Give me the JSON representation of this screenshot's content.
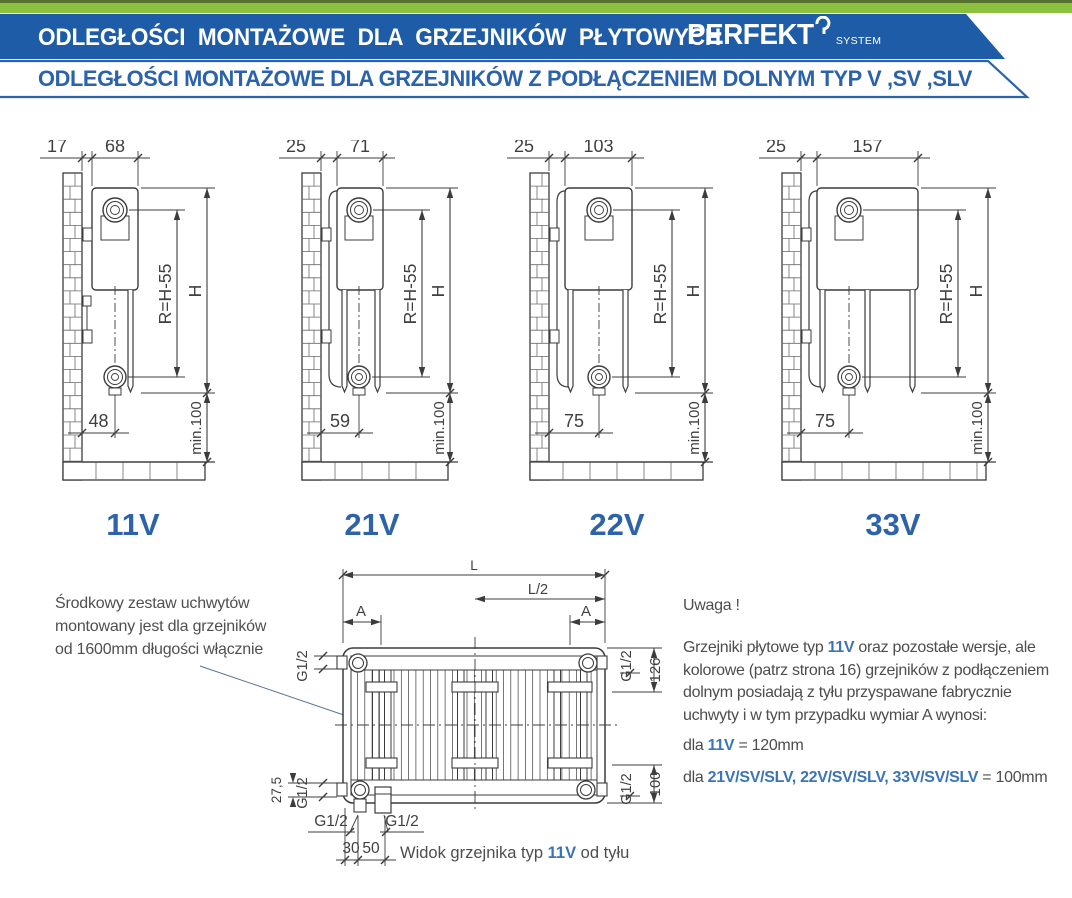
{
  "header": {
    "title_main": "ODLEGŁOŚCI  MONTAŻOWE  DLA GRZEJNIKÓW  PŁYTOWYCH",
    "logo_text": "PERFEKT",
    "logo_sub": "SYSTEM",
    "subtitle": "ODLEGŁOŚCI MONTAŻOWE DLA GRZEJNIKÓW Z PODŁĄCZENIEM DOLNYM TYP V ,SV ,SLV",
    "colors": {
      "green": "#8CC13F",
      "green_dark": "#55702F",
      "banner_blue": "#1F5CA8",
      "accent_blue": "#2B62AC",
      "label_blue": "#2E63A9",
      "inline_blue": "#3B74B8",
      "line_gray": "#3c3c3c"
    }
  },
  "diagrams": [
    {
      "type_label": "11V",
      "wall_offset": "17",
      "depth": "68",
      "bottom_offset": "48",
      "radius_dim": "R=H-55",
      "height_dim": "H",
      "min_floor": "min.100"
    },
    {
      "type_label": "21V",
      "wall_offset": "25",
      "depth": "71",
      "bottom_offset": "59",
      "radius_dim": "R=H-55",
      "height_dim": "H",
      "min_floor": "min.100"
    },
    {
      "type_label": "22V",
      "wall_offset": "25",
      "depth": "103",
      "bottom_offset": "75",
      "radius_dim": "R=H-55",
      "height_dim": "H",
      "min_floor": "min.100"
    },
    {
      "type_label": "33V",
      "wall_offset": "25",
      "depth": "157",
      "bottom_offset": "75",
      "radius_dim": "R=H-55",
      "height_dim": "H",
      "min_floor": "min.100"
    }
  ],
  "rear_view": {
    "dims": {
      "length": "L",
      "half_length": "L/2",
      "bracket_a": "A",
      "conn": "G1/2",
      "top_axis": "126",
      "bottom_axis": "100",
      "left_offset": "27,5",
      "pipe_dim_1": "30",
      "pipe_dim_2": "50"
    },
    "caption": {
      "prefix": "Widok grzejnika typ ",
      "type": "11V",
      "suffix": " od tyłu"
    }
  },
  "notes": {
    "left_lines": [
      "Środkowy zestaw uchwytów",
      "montowany jest dla grzejników",
      "od 1600mm długości włącznie"
    ],
    "warning_title": "Uwaga !",
    "w1a": "Grzejniki płytowe typ ",
    "w1b": "11V",
    "w1c": " oraz pozostałe wersje, ale",
    "w2": "kolorowe (patrz strona 16) grzejników z podłączeniem",
    "w3": "dolnym posiadają z tyłu przyspawane fabrycznie",
    "w4": "uchwyty i w tym przypadku wymiar A wynosi:",
    "w5a": "dla ",
    "w5b": "11V",
    "w5c": " = 120mm",
    "w6a": "dla ",
    "w6b": "21V/SV/SLV, 22V/SV/SLV, 33V/SV/SLV",
    "w6c": " = 100mm"
  }
}
